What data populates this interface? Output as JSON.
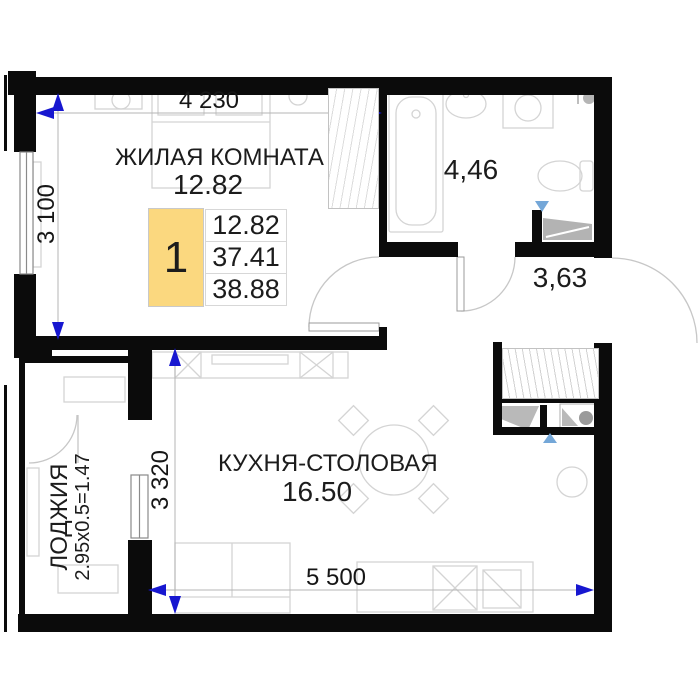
{
  "plan": {
    "info_box": {
      "number": "1",
      "values": [
        "12.82",
        "37.41",
        "38.88"
      ]
    },
    "rooms": {
      "living": {
        "name": "ЖИЛАЯ КОМНАТА",
        "area": "12.82"
      },
      "kitchen": {
        "name": "КУХНЯ-СТОЛОВАЯ",
        "area": "16.50"
      },
      "bathroom": {
        "area": "4,46"
      },
      "hall": {
        "area": "3,63"
      },
      "loggia": {
        "name": "ЛОДЖИЯ",
        "formula": "2.95x0.5=1.47"
      }
    },
    "dimensions": {
      "top": "4 230",
      "left": "3 100",
      "kitchen_left": "3 320",
      "bottom": "5 500"
    },
    "colors": {
      "wall": "#0b0b0b",
      "dimension_arrow": "#1717d0",
      "vent_marker": "#74a7d8",
      "info_highlight": "#fbd87f",
      "furniture_line": "#d4d4d4"
    }
  }
}
